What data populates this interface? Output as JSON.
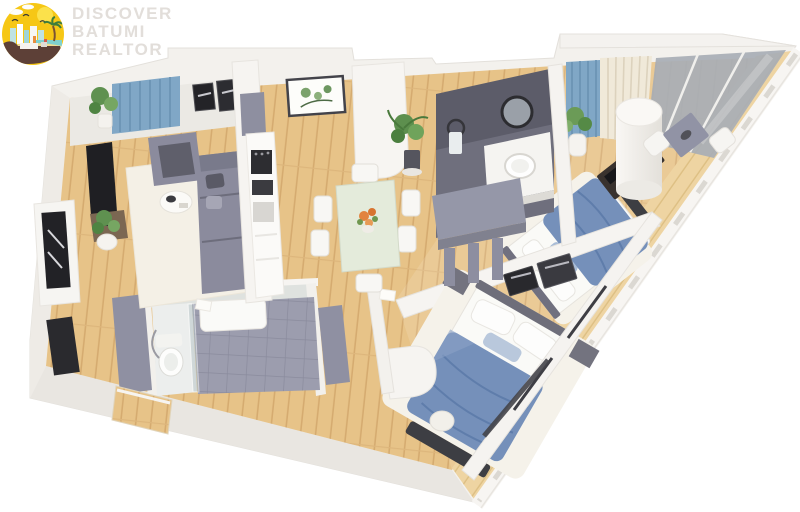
{
  "brand": {
    "line1": "DISCOVER",
    "line2": "BATUMI",
    "line3": "REALTOR",
    "logo_icon": "batumi-seaside-city-badge"
  },
  "palette": {
    "logo_yellow": "#f6c715",
    "logo_ground_brown": "#5d4037",
    "logo_sea_teal": "#7fd1cf",
    "wall_white": "#f3f1ed",
    "wood_floor": "#e7c388",
    "wood_light": "#eed4a2",
    "furniture_gray": "#8b8b9d",
    "bed_blue": "#7590ba",
    "curtain_blue": "#80a7c6",
    "bathroom_tile": "#9c9dae",
    "ensuite_wall": "#5c5c69",
    "accent_dark": "#2c2c31"
  },
  "floor_plan": {
    "view": "3d-isometric-apartment-floor-plan",
    "rooms": [
      "living-room",
      "kitchen",
      "dining-area",
      "hallway",
      "bathroom",
      "ensuite-bathroom",
      "closet",
      "bedroom-primary",
      "bedroom-second",
      "balcony",
      "entrance"
    ]
  }
}
